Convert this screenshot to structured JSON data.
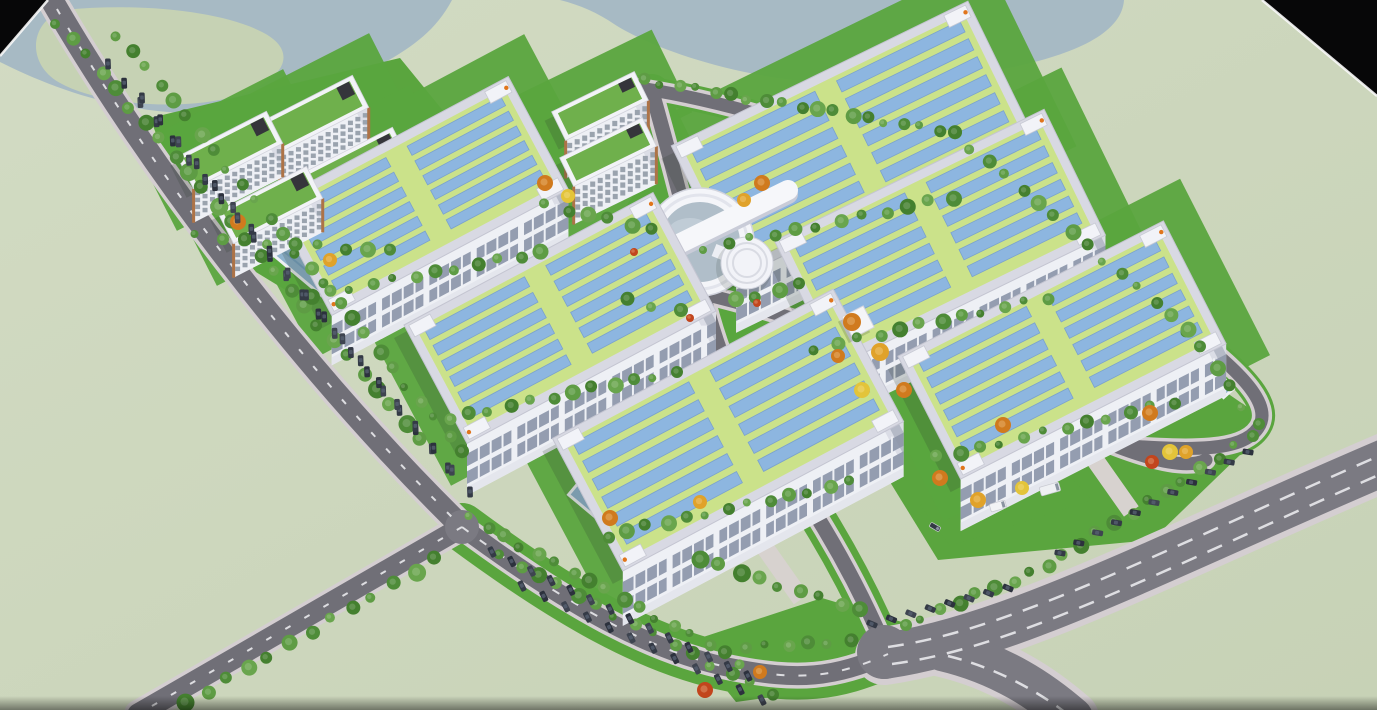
{
  "scene": {
    "canvas": {
      "w": 1377,
      "h": 710
    },
    "colors": {
      "terrain_light": "#d2dbc3",
      "terrain_dark": "#c7d2b6",
      "water": "#a7bac4",
      "island": "#c6d2b4",
      "road": "#706f77",
      "road_major": "#7b7a82",
      "casing": "#d4ced1",
      "dash": "#e9e9ec",
      "lawn": "#5aa53e",
      "roof_border": "#d8d9e3",
      "roof_green": "#cbe28a",
      "panel_blue": "#8db6e0",
      "panel_edge": "#7aa2cd",
      "facade": "#eef0f5",
      "facade_end": "#dbdde6",
      "window_band": "#949db0",
      "office_roof": "#6fb04c",
      "office_window": "#9aa3ae",
      "office_trim": "#ad7347",
      "pool": "#8fb3cd",
      "pool_rim": "#eef0f4",
      "glass_dome": "#b0bec9",
      "accent_orange": "#e0751c",
      "void": "#070708",
      "edge_line": "#fafafa",
      "tree_greens": [
        "#4e8c38",
        "#5e9c44",
        "#44802f",
        "#69a54d"
      ],
      "tree_autumn": [
        "#d07a1e",
        "#e0a22a",
        "#e3c43a",
        "#c2451d"
      ],
      "car_colors": [
        "#343a46",
        "#2c313d",
        "#3e4450"
      ]
    },
    "water_bodies": [
      {
        "name": "lake-northwest",
        "d": "M0,0 L452,0 C436,30 414,46 382,64 C324,100 238,118 168,112 C98,106 40,82 0,62 Z"
      },
      {
        "name": "lake-north",
        "d": "M560,0 L1124,0 C1122,32 1078,54 1008,68 C928,84 848,88 778,78 C700,66 642,42 614,24 C598,13 580,5 560,0 Z"
      }
    ],
    "island": {
      "d": "M64,10 C142,2 224,12 262,32 C298,50 288,78 238,96 C178,112 100,104 62,84 C26,66 28,22 64,10 Z"
    },
    "void_corners": [
      {
        "pts": "0,0 48,0 0,56"
      },
      {
        "pts": "1262,0 1377,0 1377,96"
      }
    ],
    "edge_lines": [
      [
        48,
        0,
        0,
        56
      ],
      [
        1262,
        0,
        1377,
        96
      ]
    ],
    "lawn_polys": [
      "150,118 400,58 520,205 560,262 310,305 195,235",
      "880,348 1118,318 1272,424 1152,540 938,560 858,430",
      "688,642 822,598 902,622 880,682 736,702",
      "920,505 1062,468 1092,500 950,546"
    ],
    "lawn_circles": [
      [
        706,
        252,
        92
      ]
    ],
    "lawn_bands": [
      {
        "d": "M462,527 C566,604 650,652 732,668 C798,681 834,678 888,654",
        "w": 48
      },
      {
        "d": "M652,92 C674,170 690,232 702,290 C718,356 738,400 760,432 C802,490 848,560 886,650",
        "w": 36
      },
      {
        "d": "M704,294 C850,330 1000,390 1100,440 C1158,464 1190,468 1206,460",
        "w": 32
      },
      {
        "d": "M640,88 C830,118 1020,210 1186,330 C1250,378 1272,408 1258,428 C1242,452 1190,450 1128,446",
        "w": 26
      }
    ],
    "roads": [
      {
        "d": "M640,88 C830,118 1020,210 1186,330 C1250,378 1272,408 1258,428 C1242,452 1190,450 1128,446",
        "w": 13,
        "major": false
      },
      {
        "d": "M652,92 C674,170 690,232 702,290 C718,356 738,400 760,432 C802,490 848,560 886,650",
        "w": 15,
        "major": false
      },
      {
        "d": "M704,294 C850,330 1000,390 1100,440 C1158,464 1190,468 1206,460",
        "w": 13,
        "major": false
      },
      {
        "d": "M46,-10 C140,156 300,368 462,527",
        "w": 23,
        "major": false
      },
      {
        "d": "M462,527 L138,714",
        "w": 21,
        "major": false
      },
      {
        "d": "M462,527 C566,604 650,652 732,668 C798,681 834,678 888,654",
        "w": 19,
        "major": false
      },
      {
        "d": "M884,656 C1010,638 1160,558 1390,460",
        "w": 46,
        "major": true
      },
      {
        "d": "M942,650 C1002,664 1042,692 1072,718",
        "w": 42,
        "major": true
      }
    ],
    "junctions": [
      [
        884,
        652,
        27
      ],
      [
        462,
        527,
        17
      ]
    ],
    "dash_lines": [
      {
        "d": "M888,647 C1012,630 1158,552 1388,452",
        "da": "16 12",
        "w": 2.5
      },
      {
        "d": "M892,664 C1016,648 1166,568 1390,470",
        "da": "16 12",
        "w": 2.5
      },
      {
        "d": "M948,656 C1004,670 1044,696 1070,716",
        "da": "14 10",
        "w": 2.5
      },
      {
        "d": "M46,-10 C140,156 300,368 462,527",
        "da": "6 16",
        "w": 2
      },
      {
        "d": "M462,527 L138,714",
        "da": "6 16",
        "w": 2
      },
      {
        "d": "M462,527 C566,604 650,652 732,668 C798,681 834,678 888,654",
        "da": "8 14",
        "w": 2
      }
    ],
    "pools": [
      [
        300,
        265,
        110,
        16,
        40
      ],
      [
        482,
        398,
        112,
        16,
        40
      ],
      [
        627,
        530,
        132,
        18,
        40
      ],
      [
        472,
        148,
        80,
        13,
        40
      ],
      [
        922,
        328,
        52,
        11,
        40
      ],
      [
        1212,
        375,
        46,
        10,
        48
      ]
    ],
    "warehouses": [
      {
        "cx": 420,
        "cy": 196,
        "L": 268,
        "W": 128,
        "a": -28,
        "fh": 50
      },
      {
        "cx": 852,
        "cy": 140,
        "L": 330,
        "W": 148,
        "a": -26,
        "fh": 54
      },
      {
        "cx": 560,
        "cy": 318,
        "L": 282,
        "W": 134,
        "a": -28,
        "fh": 52
      },
      {
        "cx": 940,
        "cy": 238,
        "L": 300,
        "W": 140,
        "a": -26,
        "fh": 52
      },
      {
        "cx": 728,
        "cy": 430,
        "L": 318,
        "W": 150,
        "a": -28,
        "fh": 55
      },
      {
        "cx": 1062,
        "cy": 350,
        "L": 298,
        "W": 138,
        "a": -27,
        "fh": 52
      }
    ],
    "offices": [
      {
        "cx": 230,
        "cy": 150,
        "L": 100,
        "W": 36,
        "a": -27,
        "fh": 34
      },
      {
        "cx": 316,
        "cy": 114,
        "L": 100,
        "W": 36,
        "a": -27,
        "fh": 34
      },
      {
        "cx": 270,
        "cy": 205,
        "L": 100,
        "W": 36,
        "a": -27,
        "fh": 34
      },
      {
        "cx": 356,
        "cy": 166,
        "L": 100,
        "W": 36,
        "a": -27,
        "fh": 34
      },
      {
        "cx": 600,
        "cy": 106,
        "L": 92,
        "W": 32,
        "a": -26,
        "fh": 38
      },
      {
        "cx": 608,
        "cy": 152,
        "L": 92,
        "W": 32,
        "a": -26,
        "fh": 38
      }
    ],
    "central_building": {
      "cx": 700,
      "cy": 242,
      "r_out": 54,
      "r_glass": 40,
      "bar": [
        630,
        268,
        788,
        190,
        20
      ],
      "cyl": [
        747,
        263,
        26
      ],
      "rings": [
        20,
        14
      ],
      "arm": [
        714,
        250,
        747,
        263,
        13
      ]
    },
    "canopy": {
      "x": 858,
      "y": 322,
      "s": 24,
      "a": -27
    },
    "tree_rows": [
      [
        58,
        22,
        420,
        440,
        26,
        7
      ],
      [
        118,
        34,
        462,
        452,
        26,
        6
      ],
      [
        436,
        560,
        185,
        703,
        13,
        7
      ],
      [
        470,
        518,
        742,
        662,
        17,
        6
      ],
      [
        500,
        556,
        770,
        693,
        15,
        6
      ],
      [
        645,
        80,
        955,
        133,
        19,
        6
      ],
      [
        955,
        133,
        1188,
        330,
        15,
        6
      ],
      [
        1188,
        330,
        1258,
        424,
        6,
        6
      ],
      [
        1252,
        436,
        1062,
        556,
        12,
        6
      ],
      [
        1048,
        566,
        905,
        625,
        9,
        6
      ],
      [
        310,
        296,
        540,
        252,
        12,
        6
      ],
      [
        448,
        418,
        676,
        372,
        12,
        6
      ],
      [
        606,
        536,
        850,
        482,
        13,
        6
      ],
      [
        706,
        248,
        952,
        198,
        12,
        6
      ],
      [
        816,
        348,
        1046,
        298,
        12,
        6
      ],
      [
        938,
        458,
        1172,
        402,
        12,
        6
      ],
      [
        196,
        236,
        392,
        252,
        9,
        6
      ],
      [
        545,
        205,
        652,
        230,
        6,
        6
      ],
      [
        628,
        300,
        680,
        310,
        3,
        7
      ],
      [
        736,
        300,
        800,
        285,
        4,
        7
      ],
      [
        700,
        560,
        860,
        610,
        9,
        7
      ],
      [
        745,
        648,
        850,
        640,
        6,
        6
      ]
    ],
    "autumn_trees": [
      [
        545,
        183,
        8,
        0
      ],
      [
        568,
        196,
        7,
        2
      ],
      [
        762,
        183,
        8,
        0
      ],
      [
        744,
        200,
        7,
        1
      ],
      [
        852,
        322,
        9,
        0
      ],
      [
        880,
        352,
        9,
        1
      ],
      [
        904,
        390,
        8,
        0
      ],
      [
        862,
        390,
        8,
        2
      ],
      [
        838,
        356,
        7,
        0
      ],
      [
        1150,
        413,
        8,
        0
      ],
      [
        1170,
        452,
        8,
        2
      ],
      [
        1152,
        462,
        7,
        3
      ],
      [
        1186,
        452,
        7,
        1
      ],
      [
        1003,
        425,
        8,
        0
      ],
      [
        978,
        500,
        8,
        1
      ],
      [
        1022,
        488,
        7,
        2
      ],
      [
        940,
        478,
        8,
        0
      ],
      [
        238,
        222,
        8,
        0
      ],
      [
        330,
        260,
        7,
        1
      ],
      [
        610,
        518,
        8,
        0
      ],
      [
        700,
        502,
        7,
        1
      ],
      [
        705,
        690,
        8,
        3
      ],
      [
        760,
        672,
        7,
        0
      ],
      [
        634,
        252,
        4,
        3
      ],
      [
        757,
        303,
        4,
        3
      ],
      [
        690,
        318,
        4,
        3
      ]
    ],
    "car_rows": [
      [
        108,
        64,
        448,
        468,
        22
      ],
      [
        142,
        98,
        470,
        492,
        19
      ],
      [
        492,
        552,
        748,
        676,
        14
      ],
      [
        522,
        586,
        762,
        700,
        12
      ],
      [
        1060,
        553,
        1248,
        452,
        11
      ],
      [
        872,
        624,
        1008,
        588,
        8
      ]
    ],
    "vehicles": [
      {
        "x": 998,
        "y": 506,
        "a": -16,
        "w": 16,
        "h": 8,
        "c": "#f2f3f5"
      },
      {
        "x": 1050,
        "y": 489,
        "a": -16,
        "w": 20,
        "h": 9,
        "c": "#eef0f3"
      },
      {
        "x": 935,
        "y": 527,
        "a": 30,
        "w": 11,
        "h": 5,
        "c": "#333a45"
      }
    ]
  }
}
